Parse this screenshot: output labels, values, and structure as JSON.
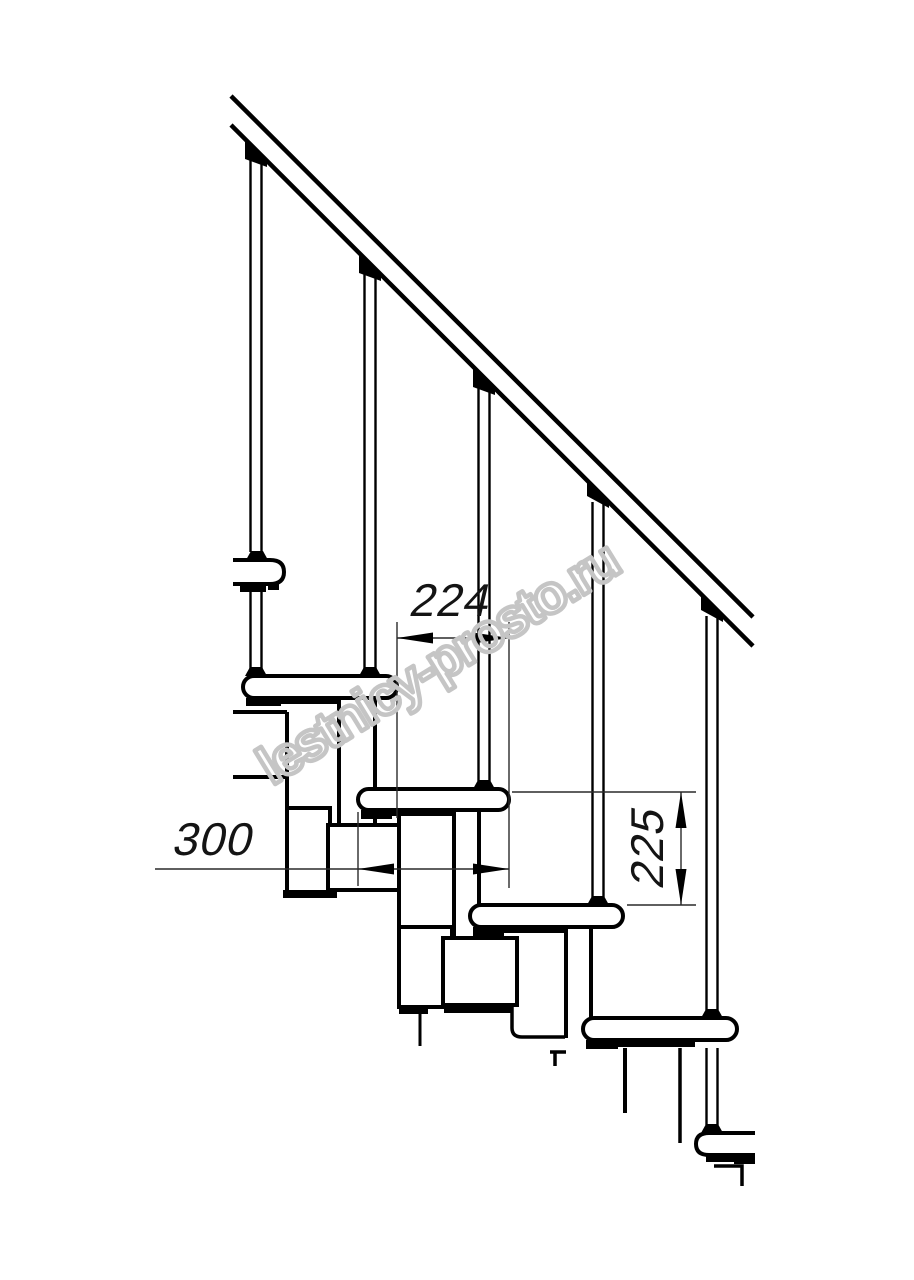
{
  "drawing": {
    "kind": "staircase-side-elevation",
    "annotations": {
      "dim_going": "224",
      "dim_tread_depth": "300",
      "dim_step_height": "225"
    },
    "watermark": {
      "text": "lestnicy-prosto.ru"
    },
    "colors": {
      "line": "#000000",
      "dim_line": "#2a2a2a",
      "background": "#ffffff",
      "watermark": "#c5c5c5"
    }
  }
}
